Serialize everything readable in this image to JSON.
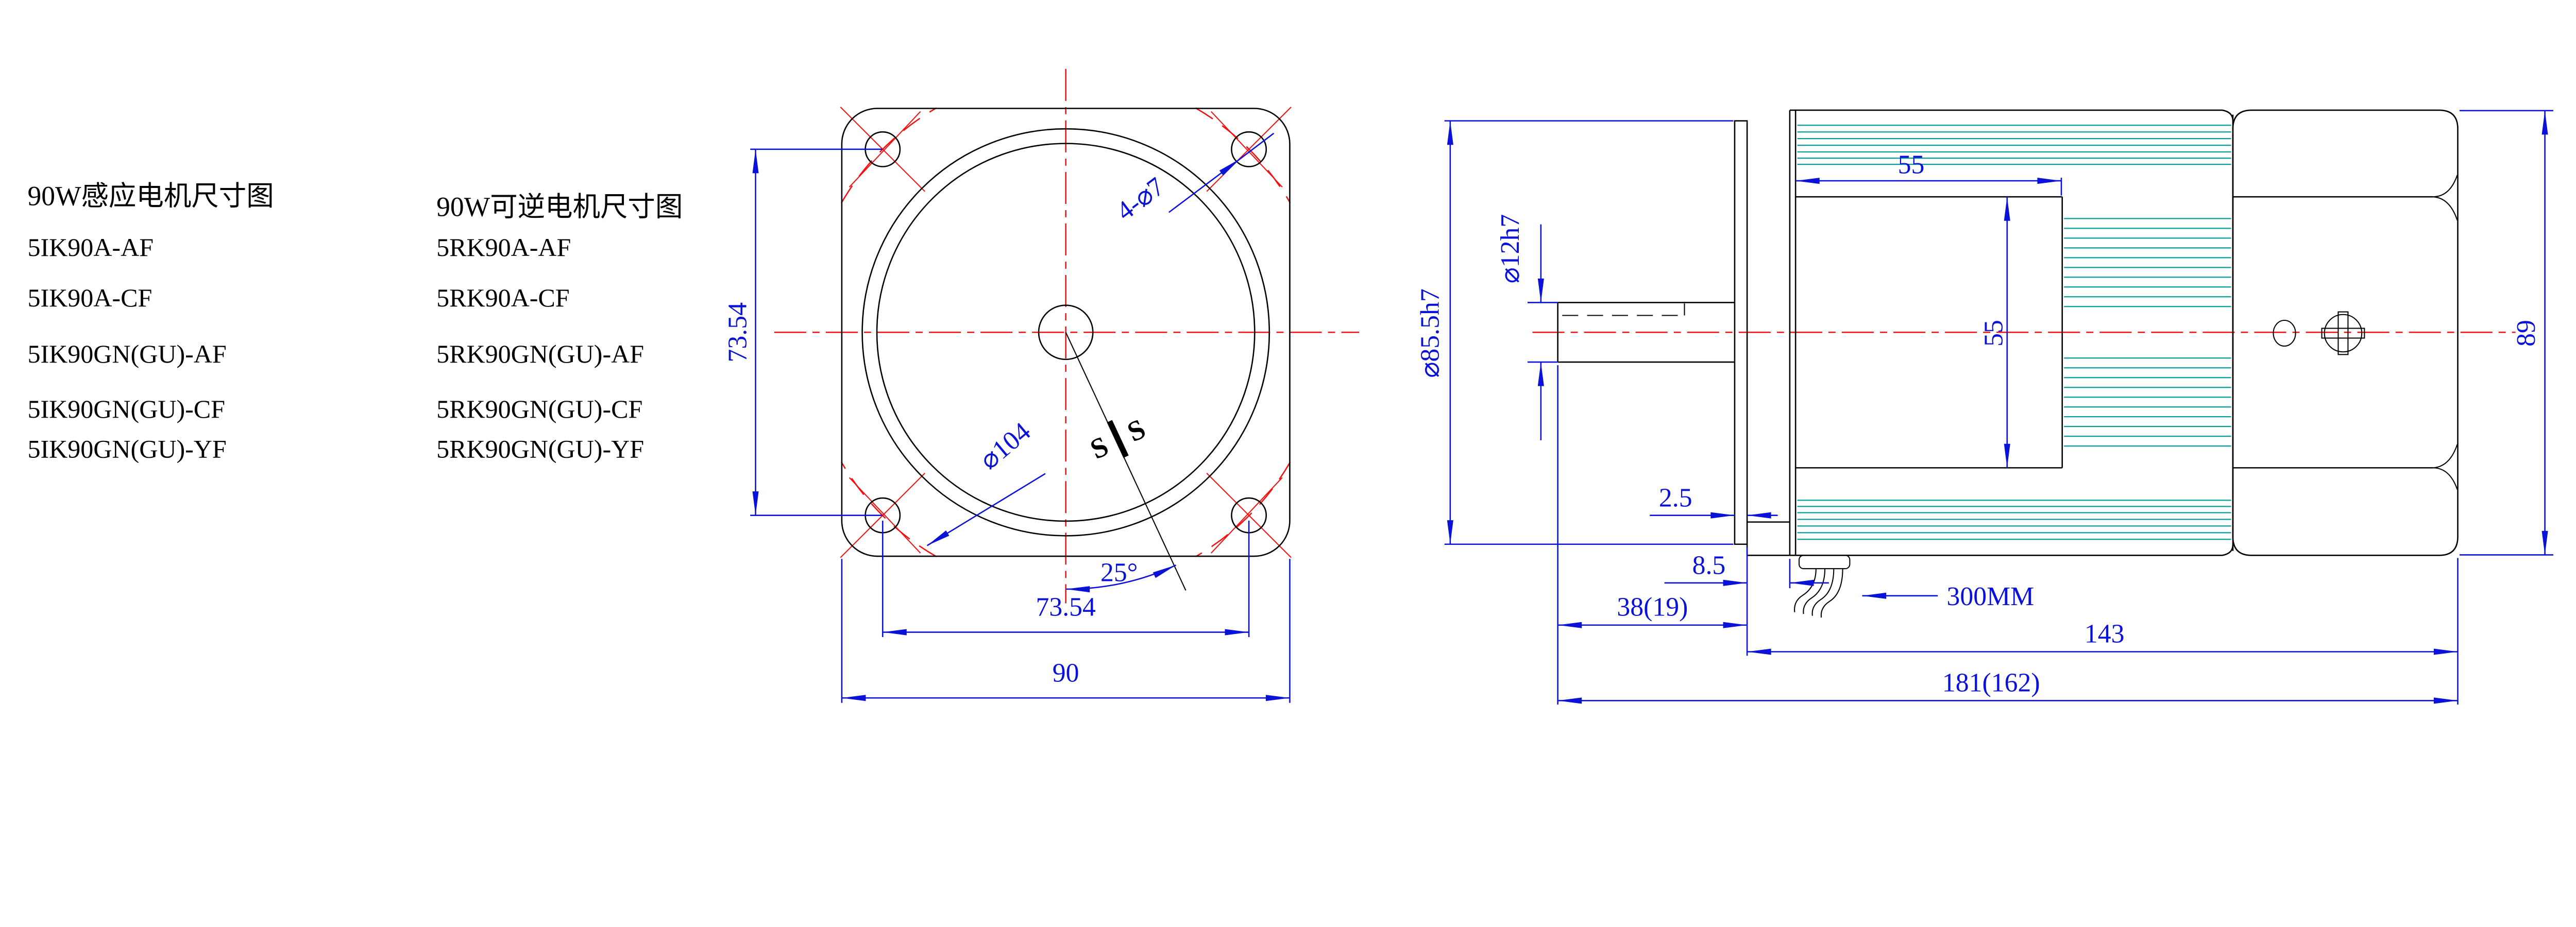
{
  "drawing": {
    "background": "#ffffff",
    "colors": {
      "dimension_blue": "#0b12d8",
      "centerline_red": "#f01212",
      "fin_teal": "#089c9c",
      "outline_black": "#000000"
    }
  },
  "models": {
    "induction": {
      "title": "90W感应电机尺寸图",
      "items": [
        "5IK90A-AF",
        "5IK90A-CF",
        "5IK90GN(GU)-AF",
        "5IK90GN(GU)-CF",
        "5IK90GN(GU)-YF"
      ]
    },
    "reversible": {
      "title": "90W可逆电机尺寸图",
      "items": [
        "5RK90A-AF",
        "5RK90A-CF",
        "5RK90GN(GU)-AF",
        "5RK90GN(GU)-CF",
        "5RK90GN(GU)-YF"
      ]
    }
  },
  "front_view": {
    "dim_bolt_spacing_v": "73.54",
    "dim_bolt_spacing_h": "73.54",
    "dim_flange_width": "90",
    "dim_bolt_holes": "4-⌀7",
    "dim_bolt_circle": "⌀104",
    "dim_angle": "25°",
    "section_mark_left": "S",
    "section_mark_right": "S"
  },
  "side_view": {
    "dim_spigot": "⌀85.5h7",
    "dim_shaft": "⌀12h7",
    "dim_gearbox_length": "55",
    "dim_body_flat": "55",
    "dim_flange_thickness": "2.5",
    "dim_terminal_depth": "8.5",
    "dim_shaft_length": "38(19)",
    "dim_cable_length": "300MM",
    "dim_body_length": "143",
    "dim_total_length": "181(162)",
    "dim_motor_height": "89"
  }
}
